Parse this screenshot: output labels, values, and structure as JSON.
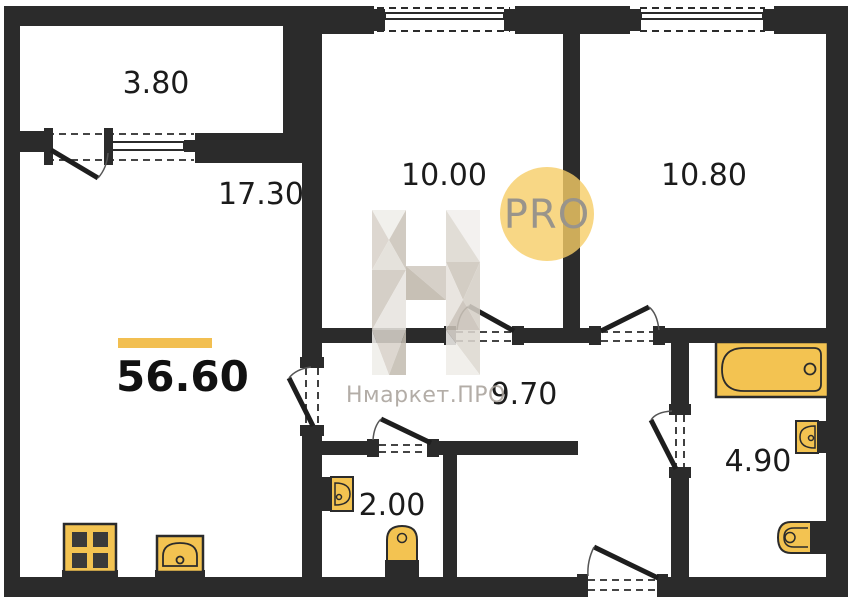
{
  "plan": {
    "total_area": "56.60",
    "rooms": [
      {
        "id": "balcony",
        "area": "3.80"
      },
      {
        "id": "living-room",
        "area": "17.30"
      },
      {
        "id": "bedroom-1",
        "area": "10.00"
      },
      {
        "id": "bedroom-2",
        "area": "10.80"
      },
      {
        "id": "hallway",
        "area": "9.70"
      },
      {
        "id": "wc",
        "area": "2.00"
      },
      {
        "id": "bathroom",
        "area": "4.90"
      }
    ],
    "colors": {
      "wall": "#2B2B2B",
      "fixture_fill": "#F3C351",
      "accent_bar": "#F2BF51",
      "badge_circle": "#F6CD66"
    }
  },
  "watermark": {
    "logo_text": "Нмаркет.ПРО",
    "badge_text": "PRO"
  }
}
